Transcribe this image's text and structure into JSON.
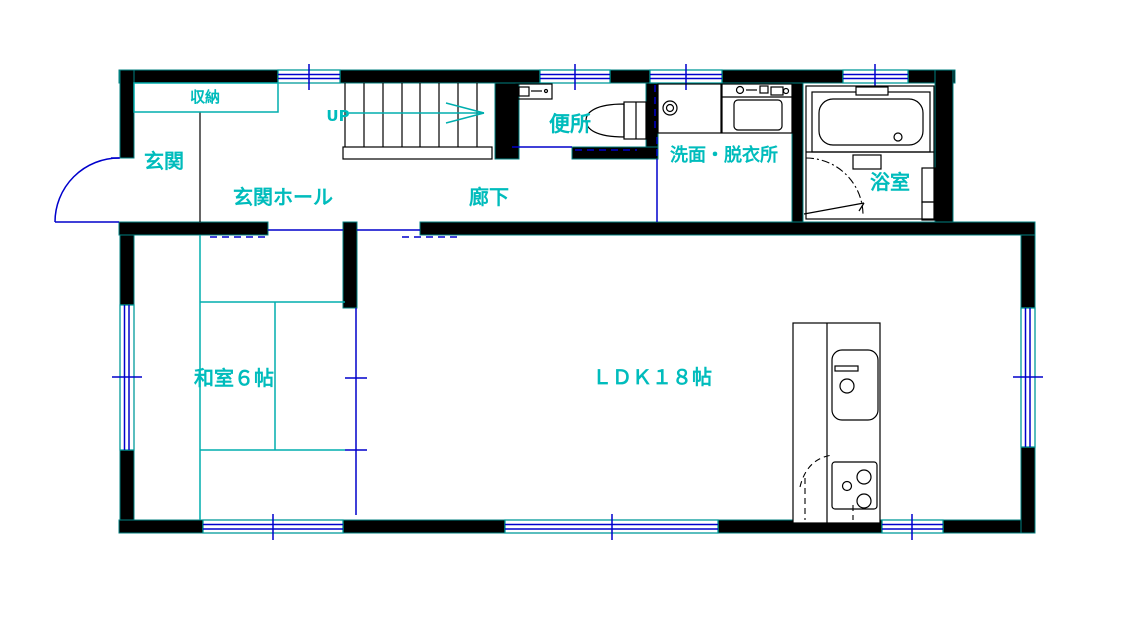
{
  "drawing": {
    "type": "japanese-house-floor-plan",
    "floor": "1F"
  },
  "labels": {
    "storage": "収納",
    "entrance": "玄関",
    "entrance_hall": "玄関ホール",
    "stairs_up": "UP",
    "toilet": "便所",
    "corridor": "廊下",
    "washroom": "洗面・脱衣所",
    "bathroom": "浴室",
    "japanese_room": "和室６帖",
    "ldk": "ＬＤＫ１８帖"
  },
  "colors": {
    "background": "#ffffff",
    "wall_fill": "#000000",
    "wall_edge": "#007f7f",
    "label_text": "#00bcbc",
    "tatami_line": "#00aeae",
    "opening_blue": "#0000cc",
    "fixture_line": "#000000"
  }
}
